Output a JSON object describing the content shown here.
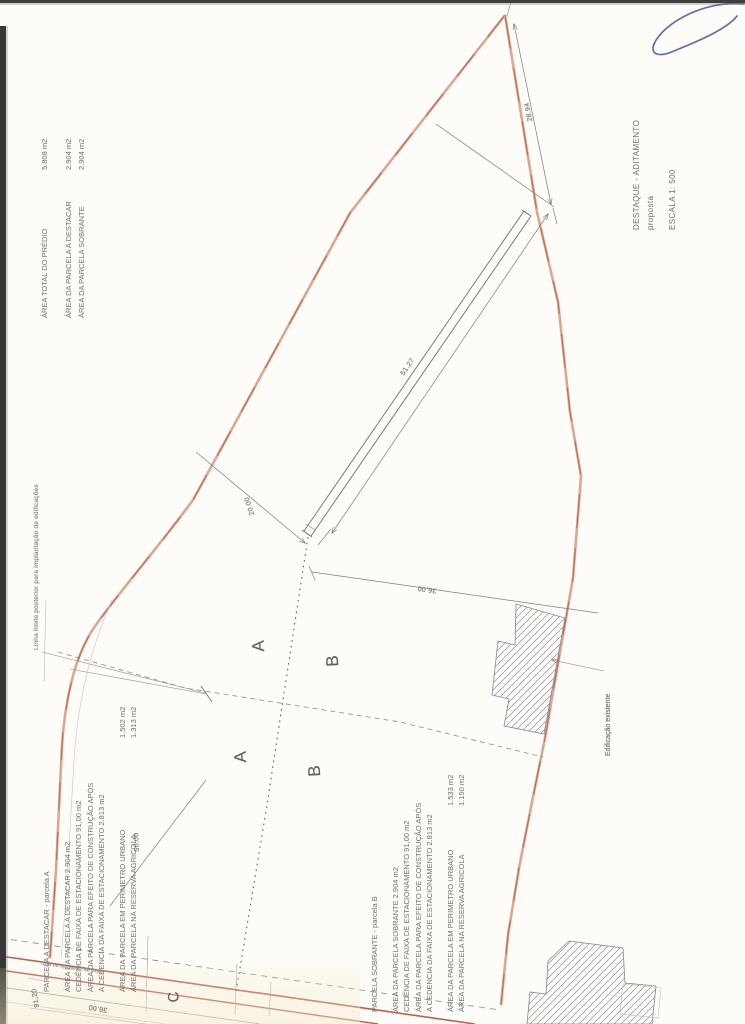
{
  "document": {
    "type_label": "DESTAQUE  -  ADITAMENTO",
    "subtitle": "proposta",
    "scale": "ESCALA  1: 500"
  },
  "summary": {
    "rows": [
      {
        "label": "ÁREA  TOTAL  DO  PRÉDIO",
        "value": "5.808 m2"
      },
      {
        "label": "ÁREA DA PARCELA A DESTACAR",
        "value": "2.904 m2"
      },
      {
        "label": "ÁREA DA PARCELA SOBRANTE",
        "value": "2.904 m2"
      }
    ]
  },
  "parcela_a": {
    "title": "PARCELA A DESTACAR   -   parcela A",
    "lines": [
      "ÁREA DA PARCELA A DESTACAR  2.904 m2",
      "CEDÊNCIA DE FAIXA DE ESTACIONAMENTO 91,00 m2",
      "ÁREA DA PARCELA PARA EFEITO DE CONSTRUÇÃO APÓS",
      "A CEDENCIA DA FAIXA DE ESTACIONAMENTO 2.813 m2"
    ],
    "rows": [
      {
        "label": "ÁREA  DA PARCELA EM PERIMETRO URBANO",
        "value": "1.502 m2"
      },
      {
        "label": "ÁREA  DA PARCELA NA RESERVA  AGRICOLA",
        "value": "1.313 m2"
      }
    ]
  },
  "parcela_b": {
    "title": "PARCELA SOBRANTE  -  parcela B",
    "lines": [
      "ÁREA DA PARCELA SOBRANTE  2.904 m2",
      "CEDÊNCIA DE FAIXA DE ESTACIONAMENTO 91,00 m2",
      "ÁREA DA PARCELA PARA EFEITO DE CONSTRUÇÃO APÓS",
      "A CEDENCIA DA FAIXA DE ESTACIONAMENTO 2.813 m2"
    ],
    "rows": [
      {
        "label": "ÁREA  DA PARCELA EM PERIMETRO URBANO",
        "value": "1.533 m2"
      },
      {
        "label": "ÁREA  DA PARCELA NA RESERVA  AGRICOLA",
        "value": "1.150 m2"
      }
    ]
  },
  "labels": {
    "a_upper": "A",
    "b_upper": "B",
    "a_lower": "A",
    "b_lower": "B",
    "road": "C"
  },
  "annotations": {
    "back_limit_line": "Linha limite posterior para implantação de edificações",
    "existing_building": "Edificação existente",
    "road_strip": "faixa de cedência ao eixo"
  },
  "dimensions": {
    "right_boundary": "28.94",
    "parking_strip": "51.27",
    "strip_offset": "20.00",
    "mid_width": "36.00",
    "road_width": "36.00",
    "road_length": "91,20",
    "left_depth": "50.00"
  },
  "colors": {
    "boundary_pink": "#d8a892",
    "boundary_core": "#b5513b",
    "road_red": "#b8604f",
    "ink_gray": "#6f6f6f",
    "pen_blue": "#5d6ea6"
  }
}
